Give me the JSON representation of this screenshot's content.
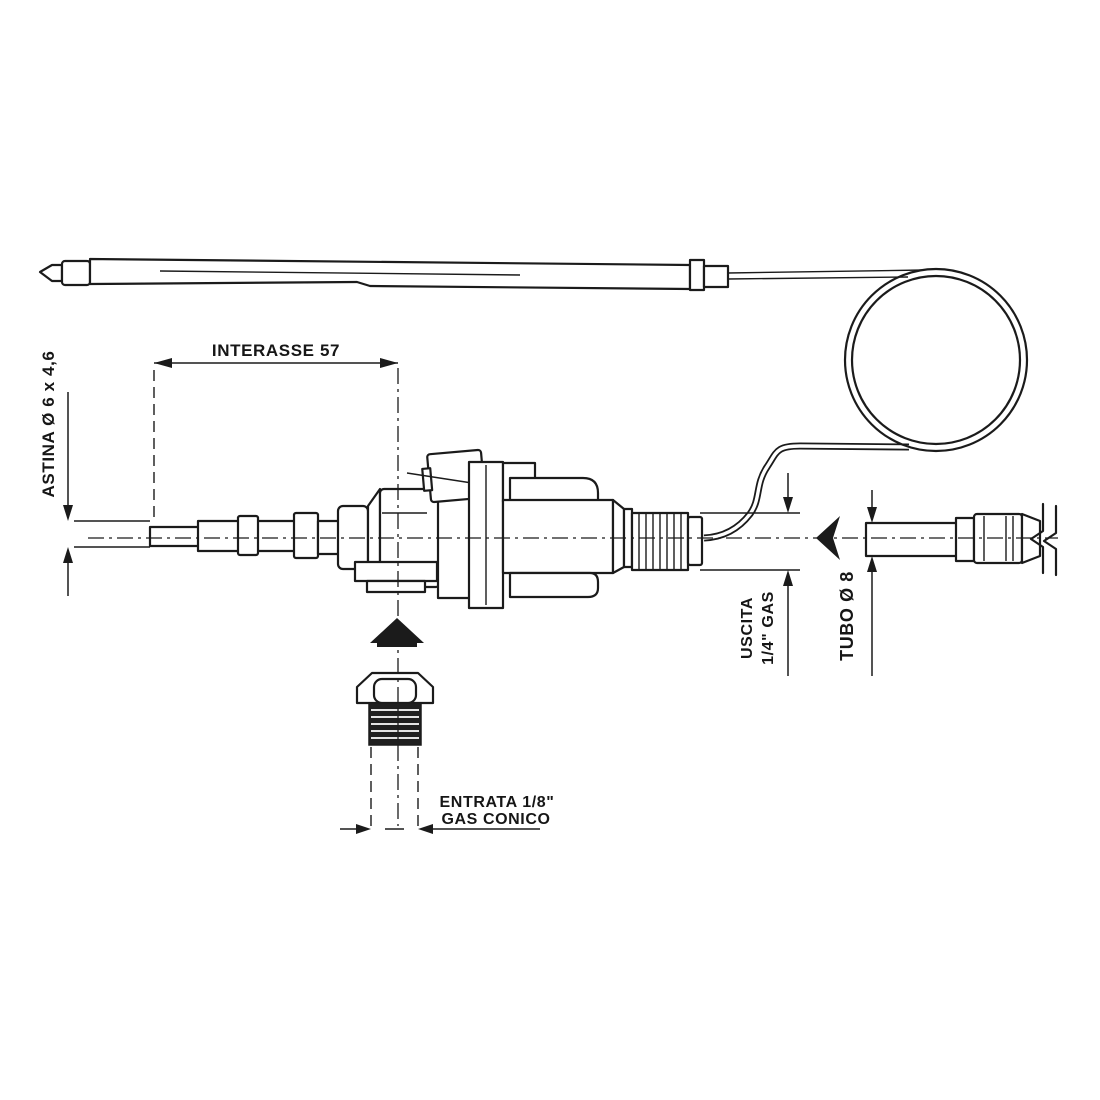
{
  "diagram": {
    "type": "technical-drawing",
    "subject": "gas-thermostat-valve-with-capillary-bulb",
    "colors": {
      "background": "#ffffff",
      "line": "#1b1b1b"
    },
    "labels": {
      "interasse": "INTERASSE 57",
      "astina": "ASTINA Ø 6 x 4,6",
      "uscita_line1": "USCITA",
      "uscita_line2": "1/4\" GAS",
      "tubo": "TUBO Ø 8",
      "entrata_line1": "ENTRATA 1/8\"",
      "entrata_line2": "GAS CONICO"
    },
    "components": [
      "bulb-probe",
      "capillary-tube",
      "capillary-coil",
      "valve-body",
      "gas-outlet-thread",
      "inlet-fitting-exploded",
      "outlet-tube"
    ]
  }
}
